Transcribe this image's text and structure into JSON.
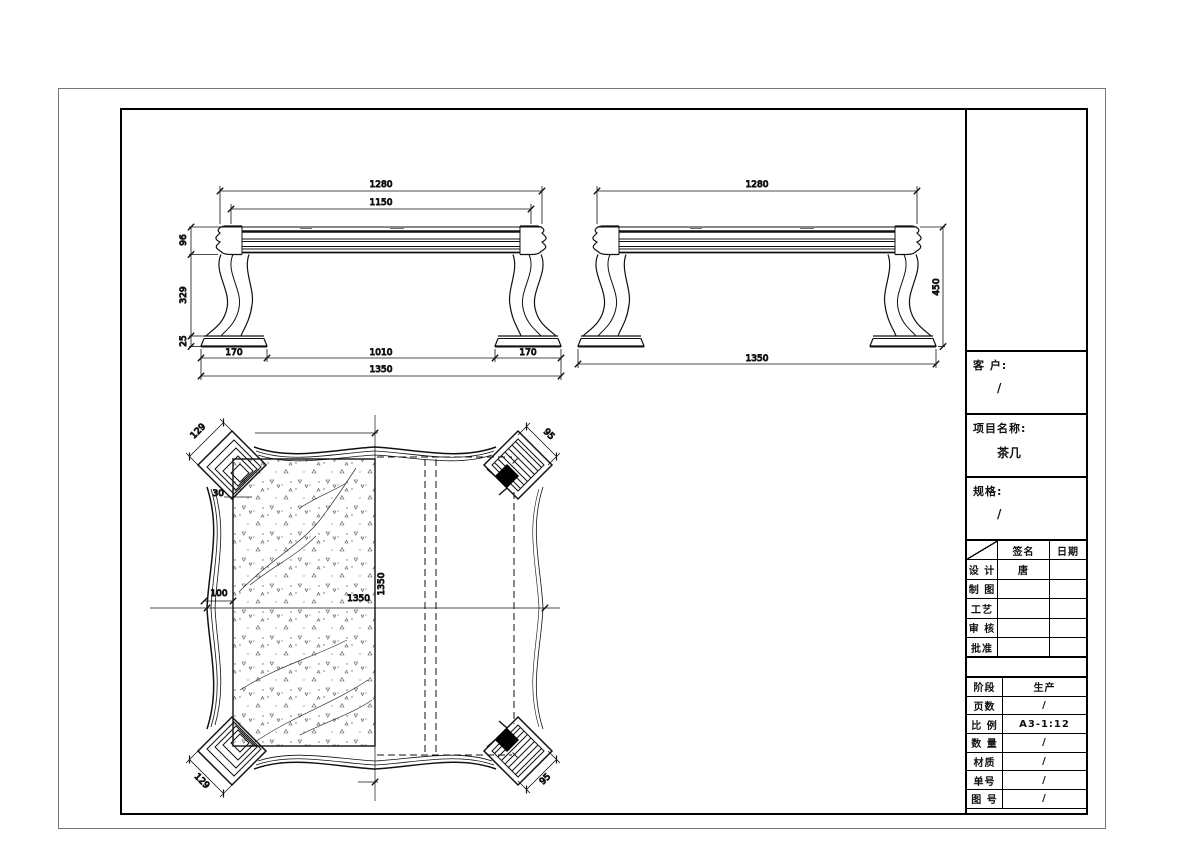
{
  "title_block": {
    "customer_label": "客 户:",
    "customer_value": "/",
    "project_label": "项目名称:",
    "project_value": "茶几",
    "spec_label": "规格:",
    "spec_value": "/",
    "sign_table": {
      "col_sign": "签名",
      "col_date": "日期",
      "rows": [
        {
          "label": "设 计",
          "sign": "唐",
          "date": ""
        },
        {
          "label": "制 图",
          "sign": "",
          "date": ""
        },
        {
          "label": "工艺",
          "sign": "",
          "date": ""
        },
        {
          "label": "审 核",
          "sign": "",
          "date": ""
        },
        {
          "label": "批准",
          "sign": "",
          "date": ""
        }
      ]
    },
    "info_table": {
      "rows": [
        {
          "label": "阶段",
          "value": "生产"
        },
        {
          "label": "页数",
          "value": "/"
        },
        {
          "label": "比 例",
          "value": "A3-1:12"
        },
        {
          "label": "数 量",
          "value": "/"
        },
        {
          "label": "材质",
          "value": "/"
        },
        {
          "label": "单号",
          "value": "/"
        },
        {
          "label": "图 号",
          "value": "/"
        }
      ]
    }
  },
  "front_view": {
    "dim_top_overall": "1280",
    "dim_top_inner": "1150",
    "dim_h_top": "96",
    "dim_h_leg": "329",
    "dim_h_foot": "25",
    "dim_foot_left": "170",
    "dim_span": "1010",
    "dim_foot_right": "170",
    "dim_overall": "1350"
  },
  "side_view": {
    "dim_top_overall": "1280",
    "dim_height": "450",
    "dim_overall": "1350"
  },
  "plan_view": {
    "dim_corner_tl": "129",
    "dim_corner_tr": "95",
    "dim_corner_bl": "129",
    "dim_corner_br": "95",
    "dim_edge": "30",
    "dim_waist": "100",
    "dim_width": "1350",
    "dim_depth": "1350"
  }
}
